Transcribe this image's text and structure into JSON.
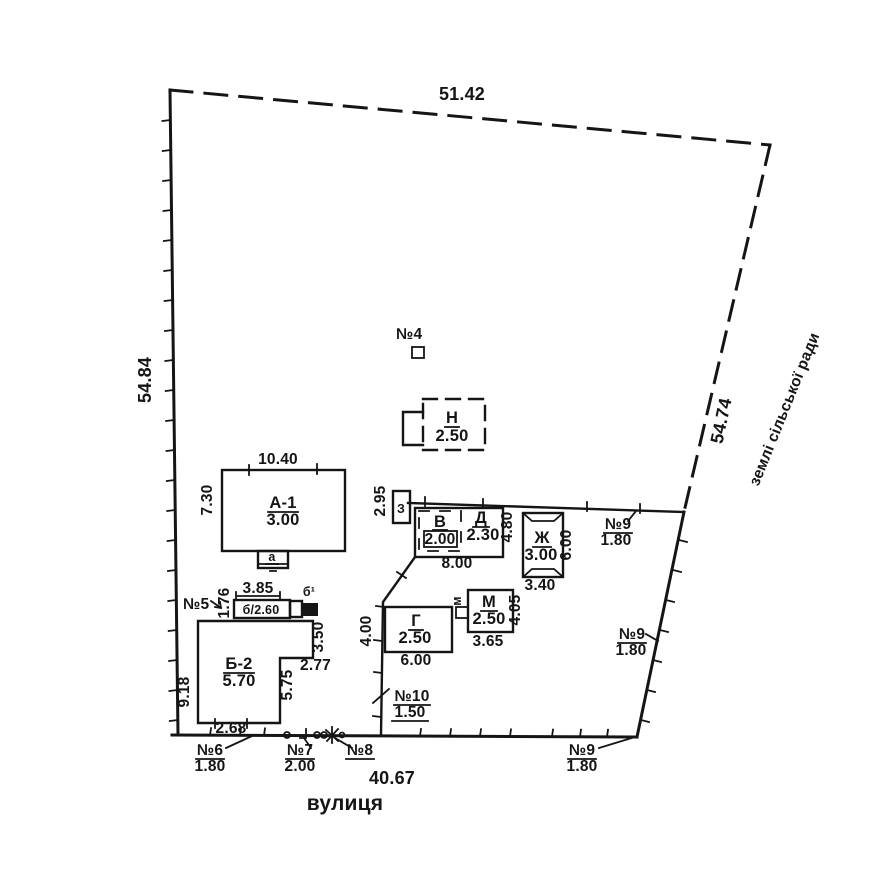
{
  "plan": {
    "boundary": {
      "top": "51.42",
      "left": "54.84",
      "right": "54.74",
      "bottom": "40.67",
      "adjacent": "землі сільської ради",
      "street": "вулиця"
    },
    "buildings": {
      "a1": {
        "label": "А-1",
        "mark": "3.00",
        "top": "10.40",
        "left": "7.30",
        "annex": "а"
      },
      "b2": {
        "label": "Б-2",
        "mark": "5.70",
        "left": "9.18",
        "bottom": "2.68",
        "inner_v": "5.75",
        "inner_h": "2.77",
        "right": "3.50"
      },
      "b_an": {
        "label": "б/2.60",
        "top": "3.85",
        "left": "1.76",
        "corner": "б¹"
      },
      "n": {
        "label": "Н",
        "mark": "2.50"
      },
      "z": {
        "label": "З",
        "left": "2.95"
      },
      "v": {
        "label": "В",
        "mark": "2.00"
      },
      "d": {
        "label": "Д",
        "mark": "2.30",
        "right": "4.80",
        "bottom": "8.00"
      },
      "zh": {
        "label": "Ж",
        "mark": "3.00",
        "right": "6.00",
        "bottom": "3.40"
      },
      "m": {
        "label": "М",
        "mark": "2.50",
        "right": "4.05",
        "bottom": "3.65",
        "annex": "м"
      },
      "g": {
        "label": "Г",
        "mark": "2.50",
        "bottom": "6.00"
      }
    },
    "fence": {
      "len": "4.00"
    },
    "markers": {
      "n4": {
        "label": "№4"
      },
      "n5": {
        "label": "№5"
      },
      "n6": {
        "label": "№6",
        "value": "1.80"
      },
      "n7": {
        "label": "№7",
        "value": "2.00"
      },
      "n8": {
        "label": "№8"
      },
      "n9_fence": {
        "label": "№9",
        "value": "1.80"
      },
      "n9_side": {
        "label": "№9",
        "value": "1.80"
      },
      "n9_corner": {
        "label": "№9",
        "value": "1.80"
      },
      "n10": {
        "label": "№10",
        "value": "1.50"
      }
    }
  }
}
